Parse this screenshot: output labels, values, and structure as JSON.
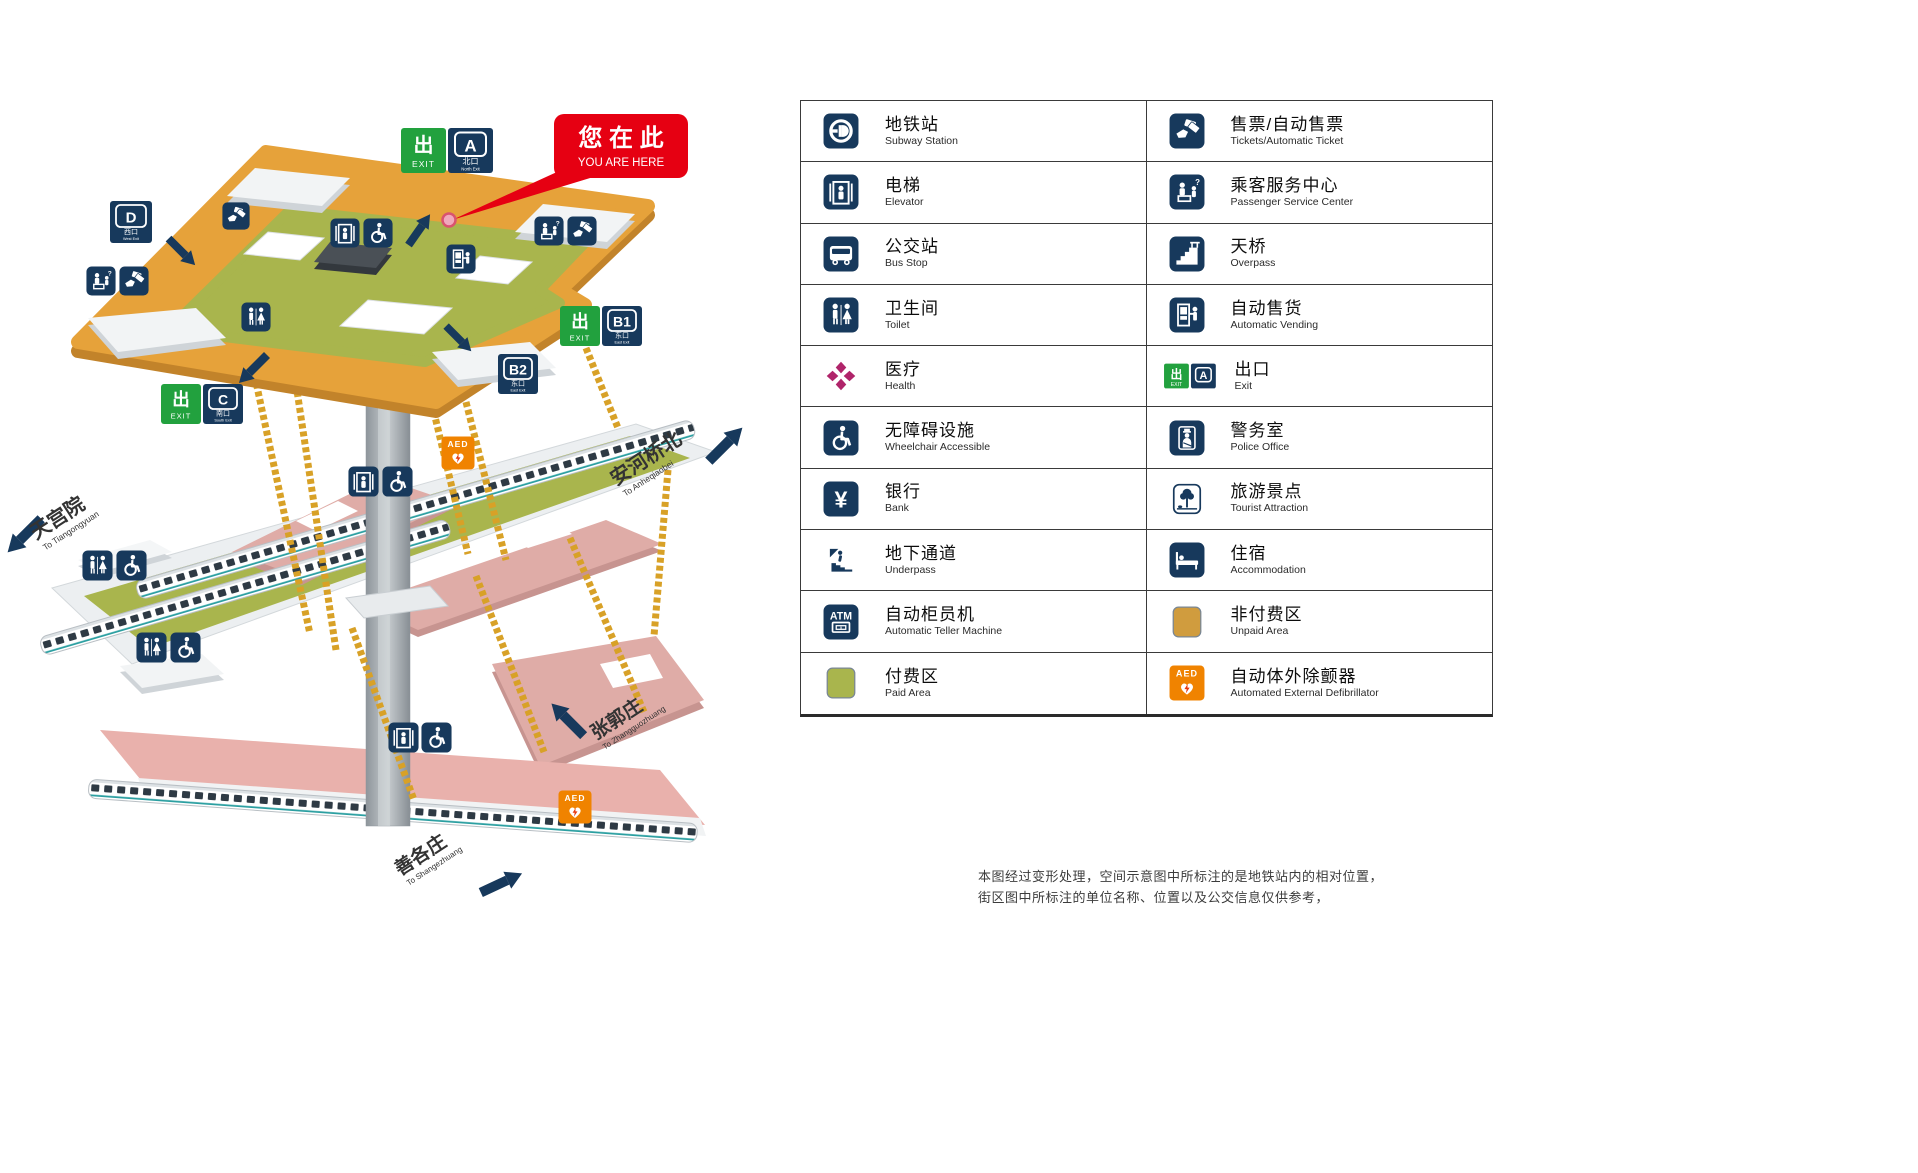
{
  "map": {
    "you_are_here": {
      "zh": "您 在 此",
      "en": "YOU ARE HERE"
    },
    "exits": {
      "a": {
        "letter": "A",
        "sub_zh": "北口",
        "sub_en": "North Exit"
      },
      "b1": {
        "letter": "B1",
        "sub_zh": "东口",
        "sub_en": "East Exit"
      },
      "b2": {
        "letter": "B2",
        "sub_zh": "东口",
        "sub_en": "East Exit"
      },
      "c": {
        "letter": "C",
        "sub_zh": "南口",
        "sub_en": "South Exit"
      },
      "d": {
        "letter": "D",
        "sub_zh": "西口",
        "sub_en": "West Exit"
      }
    },
    "directions": {
      "tiangongyuan": {
        "zh": "天宫院",
        "en": "To Tiangongyuan"
      },
      "anheqiaobei": {
        "zh": "安河桥北",
        "en": "To Anheqiaobei"
      },
      "zhangguozhuang": {
        "zh": "张郭庄",
        "en": "To Zhangguozhuang"
      },
      "shangezhuang": {
        "zh": "善各庄",
        "en": "To Shangezhuang"
      }
    }
  },
  "icon_labels": {
    "exit_zh": "出",
    "exit_en": "EXIT",
    "exit_letter": "A",
    "atm": "ATM",
    "aed": "AED",
    "yen": "¥",
    "question": "?"
  },
  "legend": {
    "columns": [
      {
        "items": [
          {
            "name": "subway-station",
            "zh": "地铁站",
            "en": "Subway Station"
          },
          {
            "name": "elevator",
            "zh": "电梯",
            "en": "Elevator"
          },
          {
            "name": "bus-stop",
            "zh": "公交站",
            "en": "Bus Stop"
          },
          {
            "name": "toilet",
            "zh": "卫生间",
            "en": "Toilet"
          },
          {
            "name": "health",
            "zh": "医疗",
            "en": "Health"
          },
          {
            "name": "wheelchair-accessible",
            "zh": "无障碍设施",
            "en": "Wheelchair Accessible"
          },
          {
            "name": "bank",
            "zh": "银行",
            "en": "Bank"
          },
          {
            "name": "underpass",
            "zh": "地下通道",
            "en": "Underpass"
          },
          {
            "name": "atm",
            "zh": "自动柜员机",
            "en": "Automatic Teller Machine"
          },
          {
            "name": "paid-area",
            "zh": "付费区",
            "en": "Paid Area"
          }
        ]
      },
      {
        "items": [
          {
            "name": "tickets",
            "zh": "售票/自动售票",
            "en": "Tickets/Automatic Ticket"
          },
          {
            "name": "passenger-service-center",
            "zh": "乘客服务中心",
            "en": "Passenger Service Center"
          },
          {
            "name": "overpass",
            "zh": "天桥",
            "en": "Overpass"
          },
          {
            "name": "automatic-vending",
            "zh": "自动售货",
            "en": "Automatic Vending"
          },
          {
            "name": "exit",
            "zh": "出口",
            "en": "Exit"
          },
          {
            "name": "police-office",
            "zh": "警务室",
            "en": "Police Office"
          },
          {
            "name": "tourist-attraction",
            "zh": "旅游景点",
            "en": "Tourist Attraction"
          },
          {
            "name": "accommodation",
            "zh": "住宿",
            "en": "Accommodation"
          },
          {
            "name": "unpaid-area",
            "zh": "非付费区",
            "en": "Unpaid Area"
          },
          {
            "name": "aed",
            "zh": "自动体外除颤器",
            "en": "Automated External Defibrillator"
          }
        ]
      }
    ]
  },
  "footnote": {
    "line1": "本图经过变形处理，空间示意图中所标注的是地铁站内的相对位置，",
    "line2": "街区图中所标注的单位名称、位置以及公交信息仅供参考，"
  },
  "colors": {
    "navy": "#17395c",
    "exit_green": "#22a13e",
    "callout_red": "#e60012",
    "floor_orange": "#e6a23a",
    "paid_olive": "#a9b54d",
    "unpaid_gold": "#d09c3e",
    "platform_pink": "#dfaca7",
    "aed_orange": "#f08300",
    "health_magenta": "#b0246a",
    "escalator_gold": "#d8a127"
  }
}
